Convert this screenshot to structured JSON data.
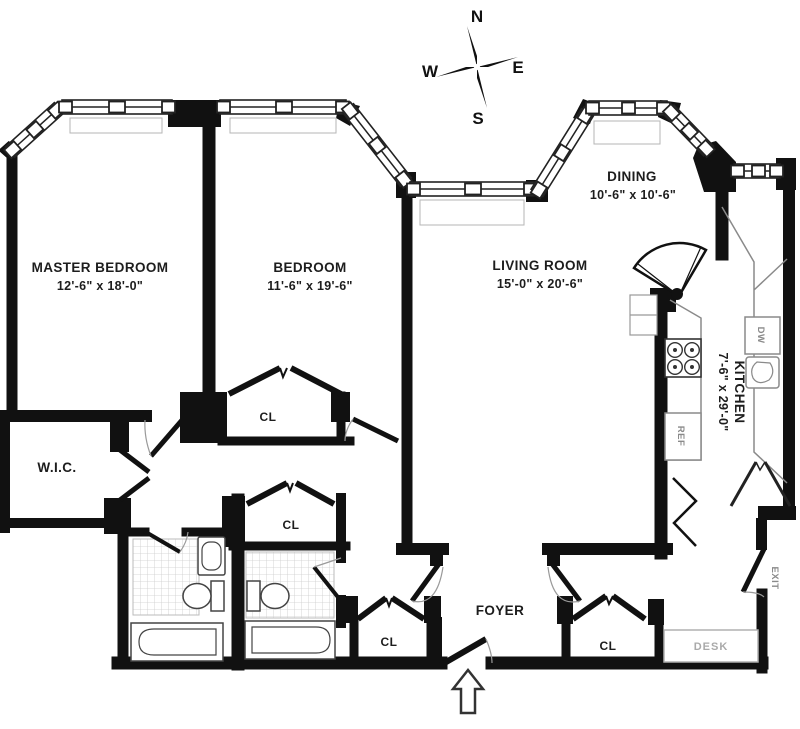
{
  "plan": {
    "rooms": {
      "master_bedroom": {
        "name": "MASTER BEDROOM",
        "dims": "12'-6\" x 18'-0\""
      },
      "bedroom": {
        "name": "BEDROOM",
        "dims": "11'-6\" x 19'-6\""
      },
      "living_room": {
        "name": "LIVING ROOM",
        "dims": "15'-0\" x 20'-6\""
      },
      "dining": {
        "name": "DINING",
        "dims": "10'-6\" x 10'-6\""
      },
      "kitchen": {
        "name": "KITCHEN",
        "dims": "7'-6\" x 29'-0\""
      },
      "wic": {
        "name": "W.I.C."
      },
      "foyer": {
        "name": "FOYER"
      }
    },
    "closets": {
      "closet1": "CL",
      "closet2": "CL",
      "closet3": "CL",
      "closet4": "CL"
    },
    "fixtures": {
      "desk": "DESK",
      "exit": "EXIT",
      "dishwasher": "DW",
      "refrigerator": "REF"
    },
    "compass": {
      "north": "N",
      "south": "S",
      "east": "E",
      "west": "W"
    },
    "colors": {
      "wall": "#111111",
      "fixture_gray": "#888888",
      "label_gray": "#aaaaaa",
      "background": "#ffffff"
    }
  }
}
